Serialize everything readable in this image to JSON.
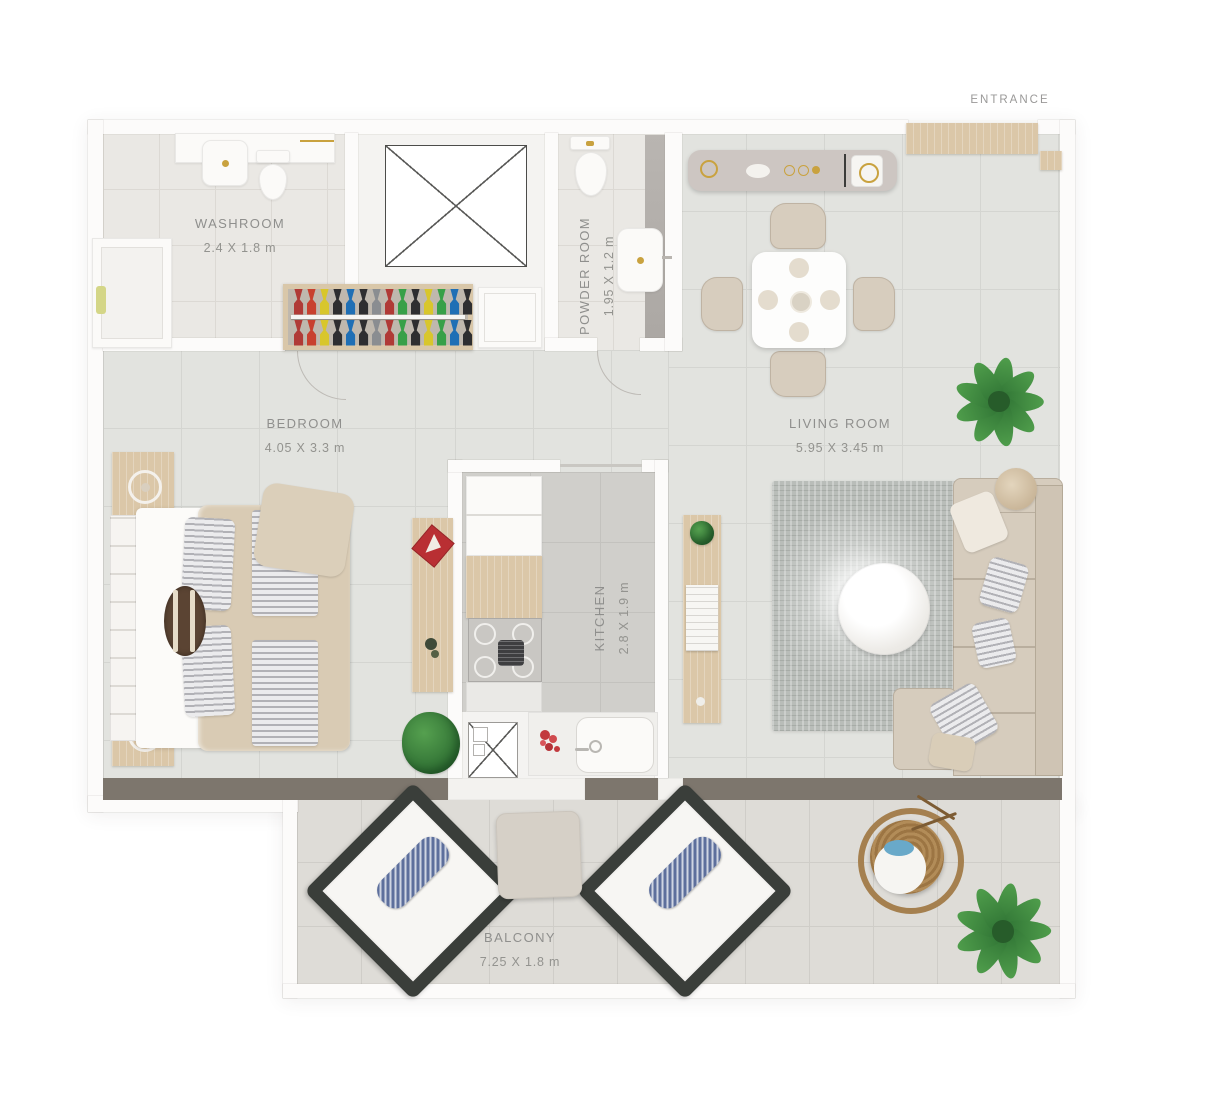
{
  "entrance": {
    "label": "ENTRANCE"
  },
  "rooms": {
    "washroom": {
      "name": "WASHROOM",
      "dims": "2.4 X 1.8 m"
    },
    "powder": {
      "name": "POWDER ROOM",
      "dims": "1.95 X 1.2 m"
    },
    "bedroom": {
      "name": "BEDROOM",
      "dims": "4.05 X 3.3 m"
    },
    "living": {
      "name": "LIVING ROOM",
      "dims": "5.95 X 3.45 m"
    },
    "kitchen": {
      "name": "KITCHEN",
      "dims": "2.8 X 1.9 m"
    },
    "balcony": {
      "name": "BALCONY",
      "dims": "7.25 X 1.8 m"
    }
  },
  "closet": {
    "hanger_colors": [
      "#b03a36",
      "#c8402f",
      "#d8c62c",
      "#2e2e30",
      "#1f6fb5",
      "#2e2e30",
      "#8a8d91",
      "#b03a36",
      "#37a048",
      "#2e2e30",
      "#d8c62c",
      "#37a048",
      "#1f6fb5",
      "#2e2e30"
    ]
  },
  "palette": {
    "wall_dark": "#7d766d",
    "wood": "#dbc7a8",
    "sofa_beige": "#d6ccbd",
    "plant_green": "#3d8b3f",
    "label_gray": "#8f8f8d",
    "balcony_frame": "#3a3e3a",
    "pillow_blue": "#5d6f9c"
  }
}
